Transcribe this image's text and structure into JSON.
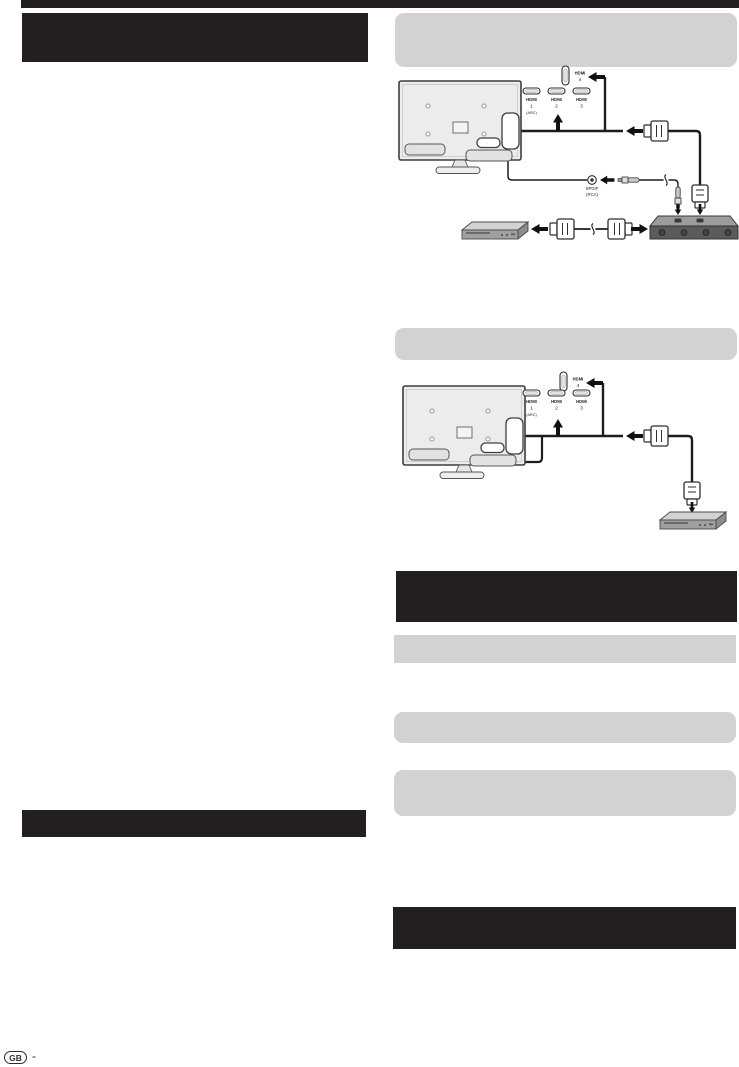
{
  "hdmi_ports": {
    "wordmark": "HDMI",
    "num1": "1",
    "num2": "2",
    "num3": "3",
    "num4": "4",
    "arc": "(ARC)"
  },
  "spdif_jack": {
    "name": "SPDIF",
    "type": "(RCA)"
  },
  "footer": {
    "region_code": "GB",
    "separator": "-"
  },
  "colors": {
    "heading_block": "#231f20",
    "note_box": "#d2d2d2",
    "diagram_ink": "#1d1d1d",
    "page_background": "#ffffff"
  }
}
